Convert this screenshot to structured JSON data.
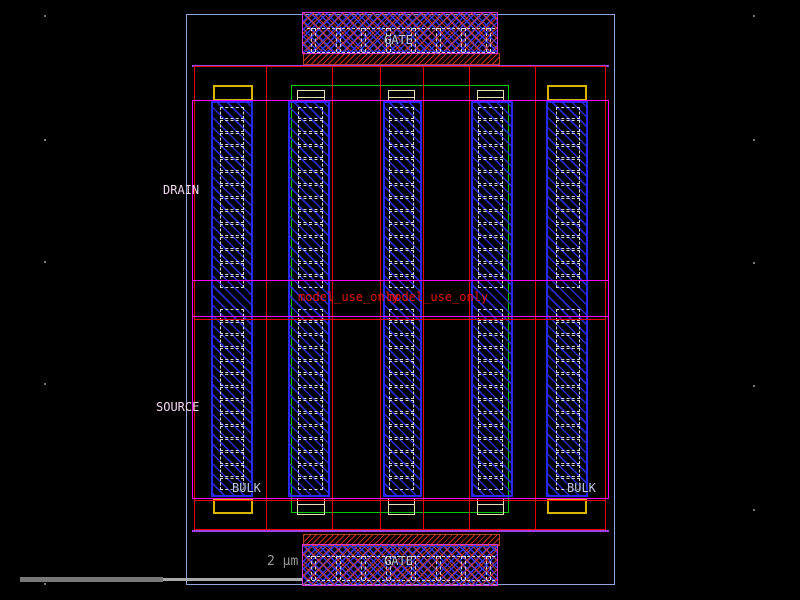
{
  "app": {
    "view": "ic-layout-canvas"
  },
  "labels": {
    "drain": "DRAIN",
    "source": "SOURCE",
    "bulk_left": "BULK",
    "bulk_right": "BULK",
    "gate_top": "GATE",
    "gate_bottom": "GATE",
    "watermark1": "model_use_only",
    "watermark2": "model_use_only",
    "scale": "2 μm"
  },
  "colors": {
    "background": "#000000",
    "boundary": "#8fa8dc",
    "red": "#e80000",
    "magenta": "#ff00ff",
    "violet": "#a040e8",
    "green": "#00c800",
    "yellow": "#d8b400",
    "tan": "#e8e0b0",
    "metal_blue": "#2828f0",
    "contact_white": "#d8d8d8",
    "label_pink": "#f0d8ee",
    "label_blue": "#bcc8e4",
    "watermark_red": "#e81010",
    "scale_gray": "#999999"
  }
}
